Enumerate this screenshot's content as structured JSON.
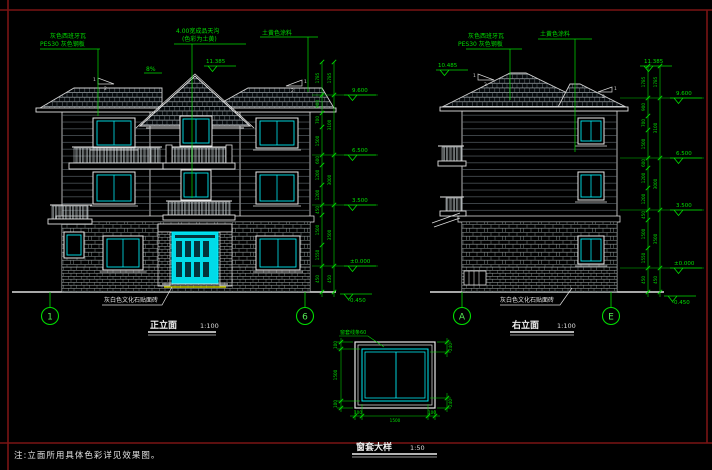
{
  "colors": {
    "green": "#00dd00",
    "cyan": "#00e8f0",
    "white": "#e6e6e6",
    "frame_red": "#7a1414",
    "yellow": "#cccc00"
  },
  "note": "注:立面所用具体色彩详见效果图。",
  "titles": {
    "front": "正立面",
    "front_scale": "1:100",
    "side": "右立面",
    "side_scale": "1:100",
    "detail": "窗套大样",
    "detail_scale": "1:50"
  },
  "grid": {
    "g1": "1",
    "g2": "6",
    "g3": "A",
    "g4": "E"
  },
  "levels": {
    "ridge": "11.385",
    "ridge2": "10.485",
    "f3": "9.600",
    "f2": "6.500",
    "f1": "3.500",
    "zero": "±0.000",
    "ground": "-0.450"
  },
  "dims": {
    "segs": [
      "1785",
      "900",
      "700",
      "1500",
      "600",
      "1200",
      "1200",
      "450",
      "1500",
      "1550",
      "450"
    ],
    "totals": [
      "1785",
      "3100",
      "3000",
      "3500",
      "450"
    ]
  },
  "detail_dims": {
    "v": [
      "100",
      "1500",
      "100"
    ],
    "h": [
      "100",
      "1500",
      "100"
    ],
    "r": [
      "240",
      "240"
    ]
  },
  "annotations": {
    "roof_tile_1": "灰色西班牙瓦",
    "roof_tile_2": "PES30 灰色钢板",
    "gutter_1": "4.00宽成品天沟",
    "gutter_2": "(色彩为土黄)",
    "paint": "土黄色涂料",
    "stone": "灰白色文化石贴面砖",
    "window_trim": "窗套线条60",
    "drain_slope": "8%"
  },
  "slope": {
    "run": "2",
    "rise": "1"
  }
}
